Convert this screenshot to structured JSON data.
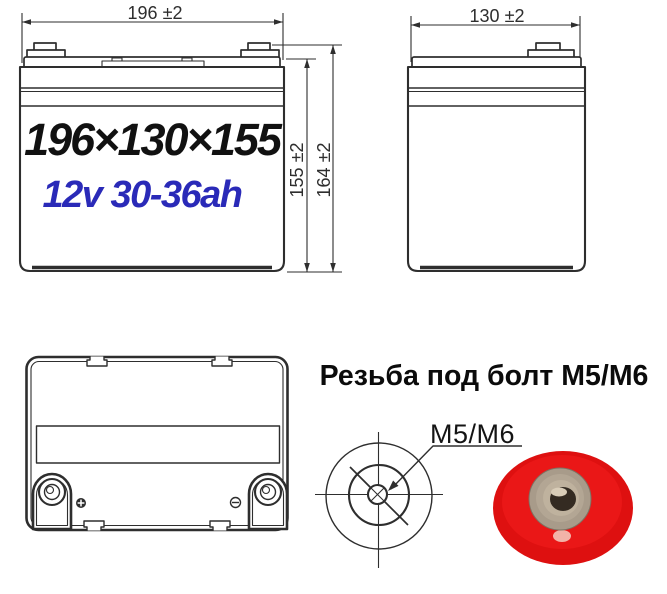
{
  "front_view": {
    "width_dim": "196 ±2",
    "lid_height_dim": "155 ±2",
    "total_height_dim": "164 ±2",
    "size_text": "196×130×155",
    "rating_text": "12v 30-36ah"
  },
  "side_view": {
    "width_dim": "130 ±2"
  },
  "bottom_view": {
    "positive_marker": "+",
    "negative_marker": "−"
  },
  "thread_note": {
    "heading": "Резьба под болт М5/М6",
    "callout": "M5/M6"
  },
  "colors": {
    "line": "#2e2e2e",
    "rating_blue": "#2a2ab8",
    "terminal_red": "#de1010",
    "nut_metal": "#a89b8a"
  }
}
